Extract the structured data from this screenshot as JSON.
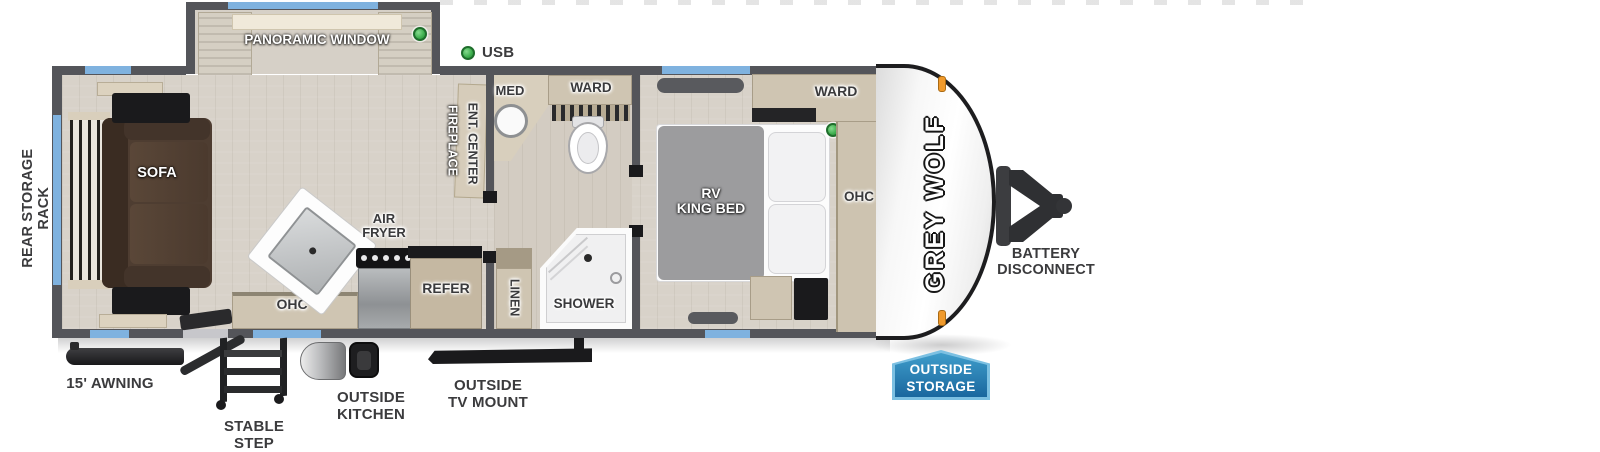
{
  "brand": {
    "name": "GREY WOLF"
  },
  "legend": {
    "usb": "USB"
  },
  "slideout": {
    "panoramic_window": "PANORAMIC WINDOW",
    "dinette": "DINETTE"
  },
  "living": {
    "sofa": "SOFA",
    "fireplace": "FIREPLACE",
    "ent_center": "ENT. CENTER",
    "ohc": "OHC",
    "air_fryer": {
      "line1": "AIR",
      "line2": "FRYER"
    },
    "refer": "REFER"
  },
  "bath": {
    "med": "MED",
    "ward": "WARD",
    "shower": "SHOWER",
    "linen": "LINEN"
  },
  "bedroom": {
    "bed": {
      "line1": "RV",
      "line2": "KING BED"
    },
    "ward": "WARD",
    "ohc": "OHC"
  },
  "exterior": {
    "rear_storage_rack": "REAR STORAGE RACK",
    "awning": "15' AWNING",
    "stable_step": "STABLE STEP",
    "outside_kitchen": "OUTSIDE KITCHEN",
    "outside_tv_mount": {
      "line1": "OUTSIDE",
      "line2": "TV MOUNT"
    },
    "outside_storage": {
      "line1": "OUTSIDE",
      "line2": "STORAGE"
    },
    "battery_disconnect": {
      "line1": "BATTERY",
      "line2": "DISCONNECT"
    }
  },
  "colors": {
    "wall": "#54555a",
    "window_blue": "#7fb2df",
    "usb_green": "#3dae4d",
    "marker_orange": "#f09a2c",
    "badge_blue": "#1b6ca8",
    "badge_border": "#7cc0e2",
    "sofa_brown": "#4e3d31",
    "cabinet_tan": "#cfc5b2",
    "floor": "#d8d2c9"
  }
}
